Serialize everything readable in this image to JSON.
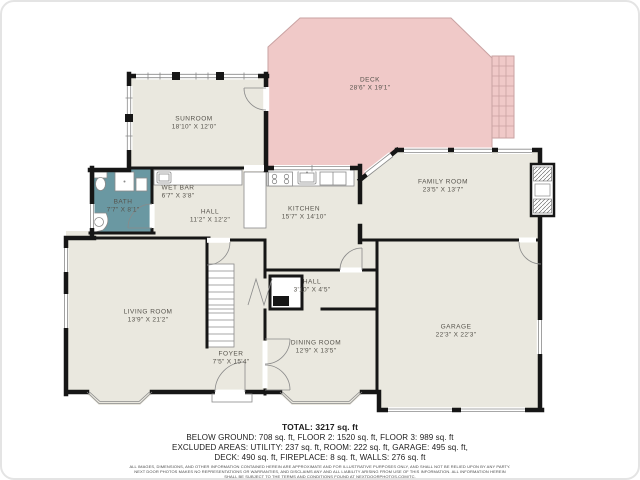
{
  "plan": {
    "rooms": [
      {
        "id": "deck",
        "name": "DECK",
        "dims": "28'6\" X 19'1\""
      },
      {
        "id": "sunroom",
        "name": "SUNROOM",
        "dims": "18'10\" X 12'0\""
      },
      {
        "id": "wet-bar",
        "name": "WET BAR",
        "dims": "6'7\" X 3'8\""
      },
      {
        "id": "bath",
        "name": "BATH",
        "dims": "7'7\" X 8'1\""
      },
      {
        "id": "hall",
        "name": "HALL",
        "dims": "11'2\" X 12'2\""
      },
      {
        "id": "kitchen",
        "name": "KITCHEN",
        "dims": "15'7\" X 14'10\""
      },
      {
        "id": "family-room",
        "name": "FAMILY ROOM",
        "dims": "23'5\" X 13'7\""
      },
      {
        "id": "living-room",
        "name": "LIVING ROOM",
        "dims": "13'9\" X 21'2\""
      },
      {
        "id": "foyer",
        "name": "FOYER",
        "dims": "7'5\" X 15'4\""
      },
      {
        "id": "hall-2",
        "name": "HALL",
        "dims": "3'10\" X 4'5\""
      },
      {
        "id": "dining-room",
        "name": "DINING ROOM",
        "dims": "12'9\" X 13'5\""
      },
      {
        "id": "garage",
        "name": "GARAGE",
        "dims": "22'3\" X 22'3\""
      }
    ],
    "colors": {
      "deck": "#f0c9c8",
      "bath": "#6a98a2",
      "floor": "#eae8df",
      "wall": "#161616"
    }
  },
  "summary": {
    "total": "TOTAL: 3217 sq. ft",
    "line1": "BELOW GROUND: 708 sq. ft, FLOOR 2: 1520 sq. ft, FLOOR 3: 989 sq. ft",
    "line2": "EXCLUDED AREAS: UTILITY: 237 sq. ft, ROOM: 222 sq. ft, GARAGE: 495 sq. ft,",
    "line3": "DECK: 490 sq. ft, FIREPLACE: 8 sq. ft, WALLS: 276 sq. ft"
  },
  "disclaimer": {
    "line1": "ALL IMAGES, DIMENSIONS, AND OTHER INFORMATION CONTAINED HEREIN ARE APPROXIMATE AND FOR ILLUSTRATIVE PURPOSES ONLY, AND SHALL NOT BE RELIED UPON BY ANY PARTY.",
    "line2": "NEXT DOOR PHOTOS MAKES NO REPRESENTATIONS OR WARRANTIES, AND DISCLAIMS ANY AND ALL LIABILITY ARISING FROM USE OF THIS INFORMATION. ALL INFORMATION HEREIN",
    "line3": "SHALL BE SUBJECT TO THE TERMS AND CONDITIONS FOUND AT NEXTDOORPHOTOS.COM/TC."
  }
}
